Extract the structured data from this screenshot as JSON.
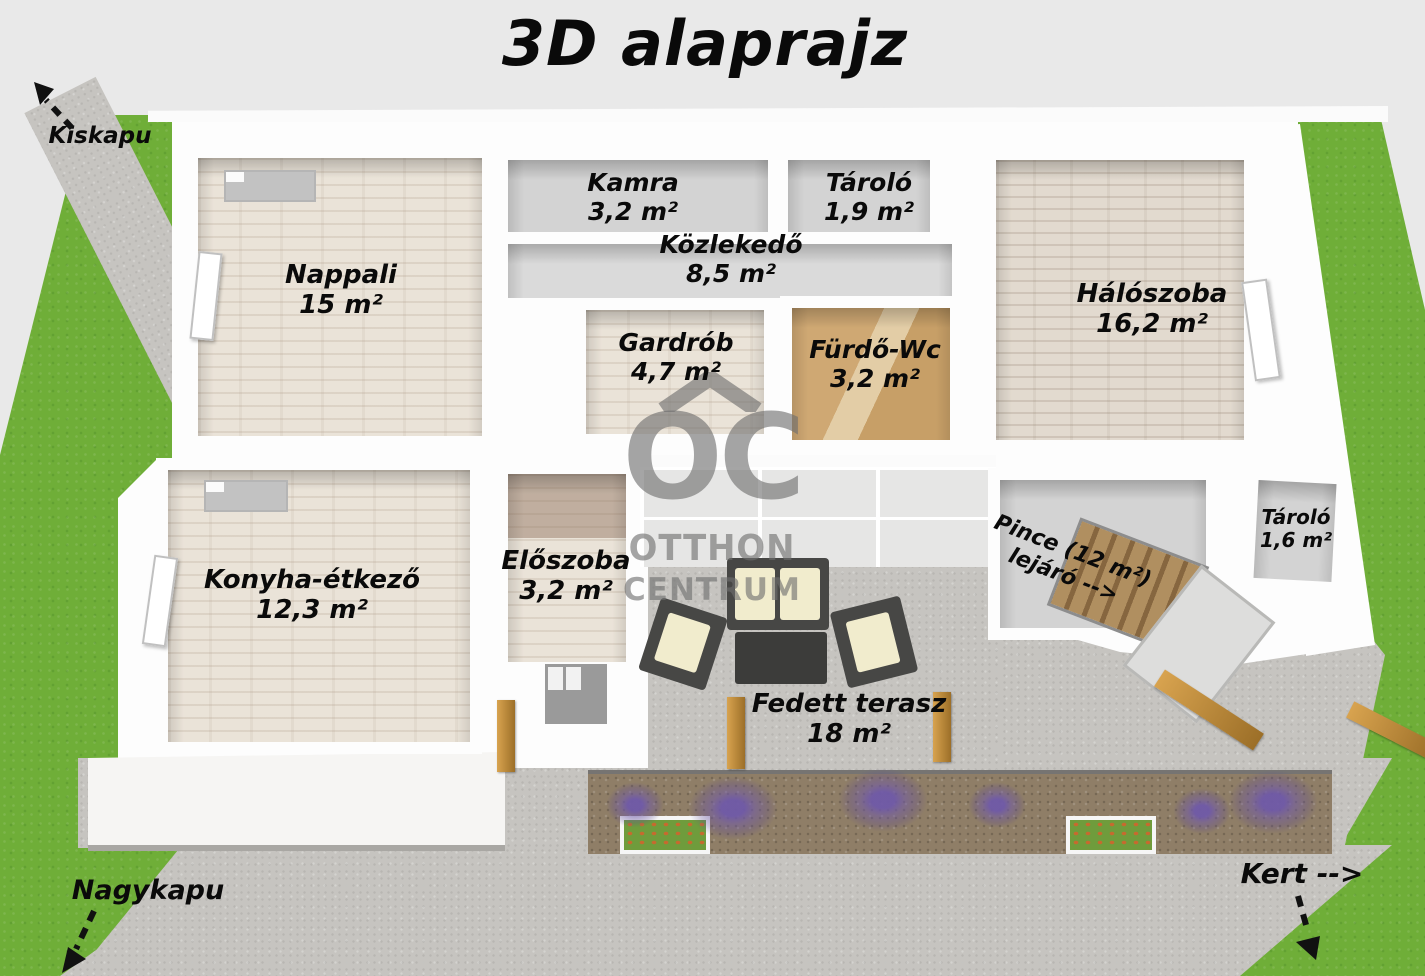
{
  "title": "3D alaprajz",
  "watermark": {
    "logo": "OC",
    "line1": "OTTHON",
    "line2": "CENTRUM"
  },
  "outdoor": {
    "kiskapu": "Kiskapu",
    "nagykapu": "Nagykapu",
    "kert": "Kert -->"
  },
  "rooms": [
    {
      "name": "Nappali",
      "area": "15 m²"
    },
    {
      "name": "Kamra",
      "area": "3,2 m²"
    },
    {
      "name": "Tároló",
      "area": "1,9 m²"
    },
    {
      "name": "Közlekedő",
      "area": "8,5 m²"
    },
    {
      "name": "Gardrób",
      "area": "4,7 m²"
    },
    {
      "name": "Fürdő-Wc",
      "area": "3,2 m²"
    },
    {
      "name": "Hálószoba",
      "area": "16,2 m²"
    },
    {
      "name": "Konyha-étkező",
      "area": "12,3 m²"
    },
    {
      "name": "Előszoba",
      "area": "3,2 m²"
    },
    {
      "name": "Tároló",
      "area": "1,6 m²"
    },
    {
      "name": "Fedett terasz",
      "area": "18 m²"
    }
  ],
  "pince": {
    "line1": "Pince (12 m²)",
    "line2": "lejáró -->"
  },
  "colors": {
    "background": "#e9e9e9",
    "grass": "#6fae38",
    "paving": "#c6c4c0",
    "house_wall_white": "#fdfdfd",
    "wall_shadow_gray": "#9a9a9a",
    "wood_floor": "#eae3d8",
    "bathroom_tile_tan": "#cfa873",
    "soil_brown": "#8f7e67",
    "lavender_purple": "#6f59a8",
    "wood_post_tan": "#c08c3e",
    "furniture_dark": "#474745",
    "cushion_cream": "#f1eccd",
    "label_black": "#0a0a0a",
    "watermark_gray": "#6e6e6e"
  }
}
